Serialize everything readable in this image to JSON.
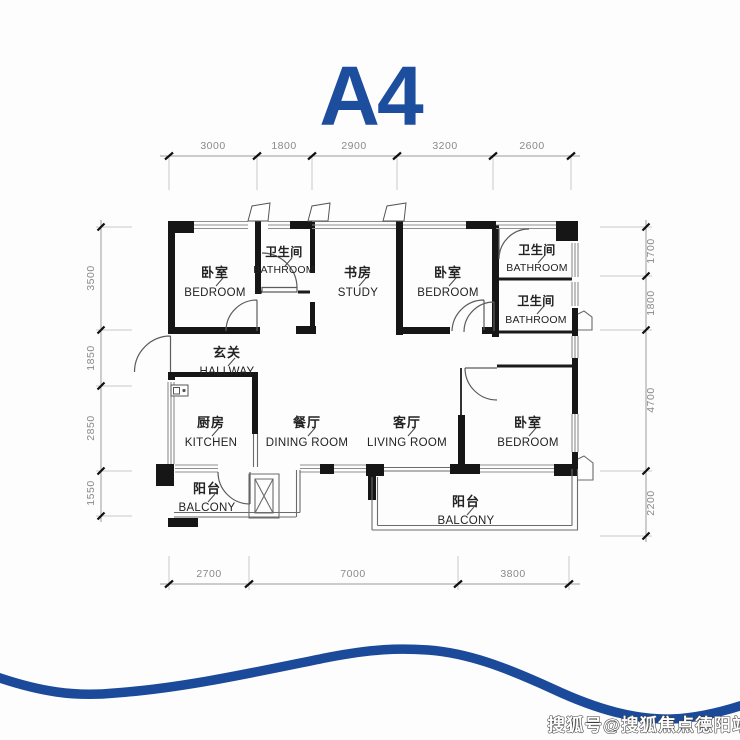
{
  "title": "A4",
  "accent_color": "#1d4e9e",
  "wave_color": "#1b4a9a",
  "watermark": "搜狐号@搜狐焦点德阳站",
  "rooms": [
    {
      "id": "bedroom-1",
      "cn": "卧室",
      "en": "BEDROOM"
    },
    {
      "id": "bathroom-1",
      "cn": "卫生间",
      "en": "BATHROOM"
    },
    {
      "id": "study",
      "cn": "书房",
      "en": "STUDY"
    },
    {
      "id": "bedroom-2",
      "cn": "卧室",
      "en": "BEDROOM"
    },
    {
      "id": "bathroom-2",
      "cn": "卫生间",
      "en": "BATHROOM"
    },
    {
      "id": "bathroom-3",
      "cn": "卫生间",
      "en": "BATHROOM"
    },
    {
      "id": "hallway",
      "cn": "玄关",
      "en": "HALLWAY"
    },
    {
      "id": "kitchen",
      "cn": "厨房",
      "en": "KITCHEN"
    },
    {
      "id": "dining-room",
      "cn": "餐厅",
      "en": "DINING ROOM"
    },
    {
      "id": "living-room",
      "cn": "客厅",
      "en": "LIVING ROOM"
    },
    {
      "id": "bedroom-3",
      "cn": "卧室",
      "en": "BEDROOM"
    },
    {
      "id": "balcony-1",
      "cn": "阳台",
      "en": "BALCONY"
    },
    {
      "id": "balcony-2",
      "cn": "阳台",
      "en": "BALCONY"
    }
  ],
  "dimensions": {
    "top": [
      "3000",
      "1800",
      "2900",
      "3200",
      "2600"
    ],
    "bottom": [
      "2700",
      "7000",
      "3800"
    ],
    "left": [
      "3500",
      "1850",
      "2850",
      "1550"
    ],
    "right": [
      "1700",
      "1800",
      "4700",
      "2200"
    ]
  }
}
